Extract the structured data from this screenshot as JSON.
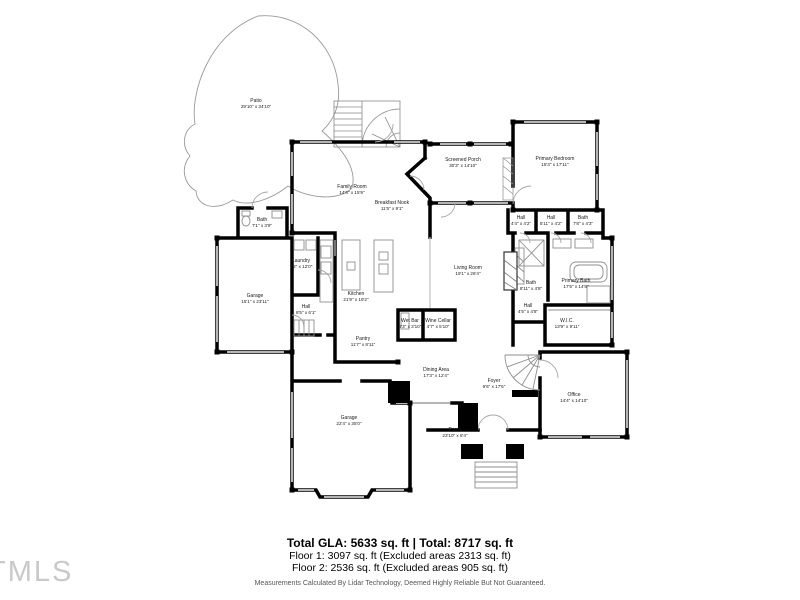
{
  "floor_plan": {
    "rooms": [
      {
        "id": "patio",
        "name": "Patio",
        "dims": "29'10\" x 34'10\""
      },
      {
        "id": "family-room",
        "name": "Family Room",
        "dims": "14'6\" x 15'9\""
      },
      {
        "id": "screened-porch",
        "name": "Screened Porch",
        "dims": "30'3\" x 14'10\""
      },
      {
        "id": "primary-bedroom",
        "name": "Primary Bedroom",
        "dims": "15'3\" x 17'11\""
      },
      {
        "id": "breakfast-nook",
        "name": "Breakfast Nook",
        "dims": "11'5\" x 9'1\""
      },
      {
        "id": "hall-a",
        "name": "Hall",
        "dims": "4'4\" x 4'2\""
      },
      {
        "id": "hall-b",
        "name": "Hall",
        "dims": "5'11\" x 4'2\""
      },
      {
        "id": "bath-a",
        "name": "Bath",
        "dims": "7'8\" x 4'3\""
      },
      {
        "id": "bath-b",
        "name": "Bath",
        "dims": "7'1\" x 3'9\""
      },
      {
        "id": "laundry",
        "name": "Laundry",
        "dims": "7'2\" x 12'0\""
      },
      {
        "id": "garage-1",
        "name": "Garage",
        "dims": "15'1\" x 23'11\""
      },
      {
        "id": "hall-c",
        "name": "Hall",
        "dims": "8'5\" x 6'1\""
      },
      {
        "id": "kitchen",
        "name": "Kitchen",
        "dims": "21'9\" x 19'2\""
      },
      {
        "id": "living-room",
        "name": "Living Room",
        "dims": "19'1\" x 26'4\""
      },
      {
        "id": "bath-c",
        "name": "Bath",
        "dims": "8'11\" x 4'8\""
      },
      {
        "id": "primary-bath",
        "name": "Primary Bath",
        "dims": "17'5\" x 14'8\""
      },
      {
        "id": "hall-d",
        "name": "Hall",
        "dims": "4'5\" x 4'8\""
      },
      {
        "id": "wic",
        "name": "W.I.C.",
        "dims": "13'9\" x 9'11\""
      },
      {
        "id": "wet-bar",
        "name": "Wet Bar",
        "dims": "8'3\" x 3'10\""
      },
      {
        "id": "wine-cellar",
        "name": "Wine Cellar",
        "dims": "4'7\" x 5'10\""
      },
      {
        "id": "pantry",
        "name": "Pantry",
        "dims": "11'7\" x 8'11\""
      },
      {
        "id": "dining-area",
        "name": "Dining Area",
        "dims": "17'3\" x 12'4\""
      },
      {
        "id": "foyer",
        "name": "Foyer",
        "dims": "9'6\" x 17'6\""
      },
      {
        "id": "office",
        "name": "Office",
        "dims": "14'4\" x 14'10\""
      },
      {
        "id": "porch",
        "name": "Porch",
        "dims": "23'10\" x 8'4\""
      },
      {
        "id": "garage-2",
        "name": "Garage",
        "dims": "22'4\" x 35'0\""
      }
    ],
    "footer": {
      "total_line": "Total GLA: 5633 sq. ft | Total: 8717 sq. ft",
      "floor1_line": "Floor 1: 3097 sq. ft (Excluded areas 2313 sq. ft)",
      "floor2_line": "Floor 2: 2536 sq. ft (Excluded areas 905 sq. ft)",
      "disclaimer": "Measurements Calculated By Lidar Technology, Deemed Highly Reliable But Not Guaranteed."
    },
    "watermark": "TMLS",
    "colors": {
      "wall": "#000000",
      "window": "#b5b5b5",
      "fixture": "#8f8f8f",
      "background": "#ffffff"
    }
  }
}
